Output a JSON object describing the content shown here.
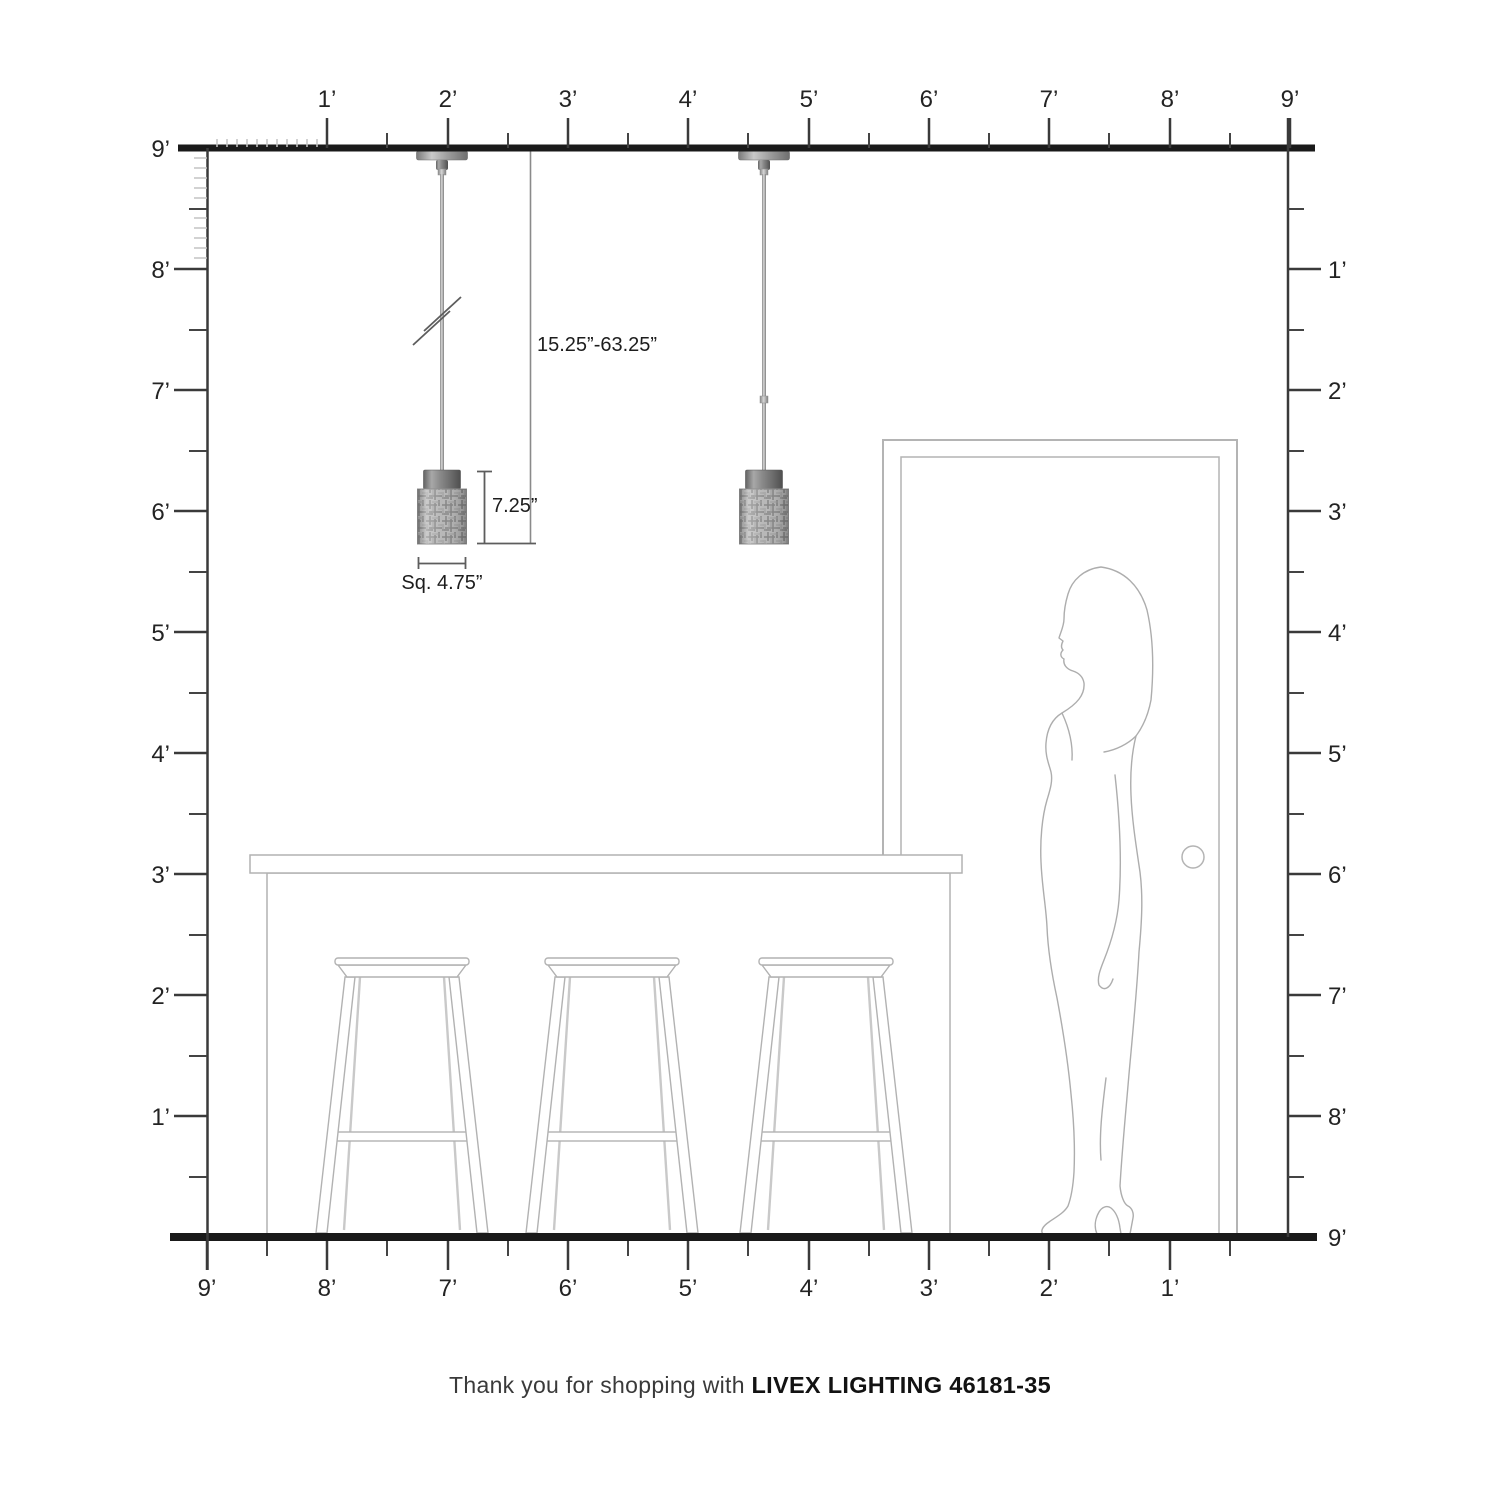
{
  "diagram": {
    "type": "product scale drawing",
    "scene": "two mini pendant lights over kitchen island with three bar stools, door and standing woman for scale"
  },
  "rulers": {
    "unit": "feet",
    "top": {
      "labels": [
        "1’",
        "2’",
        "3’",
        "4’",
        "5’",
        "6’",
        "7’",
        "8’",
        "9’"
      ]
    },
    "left": {
      "labels": [
        "9’",
        "8’",
        "7’",
        "6’",
        "5’",
        "4’",
        "3’",
        "2’",
        "1’"
      ]
    },
    "right": {
      "labels": [
        "1’",
        "2’",
        "3’",
        "4’",
        "5’",
        "6’",
        "7’",
        "8’",
        "9’"
      ]
    },
    "bottom": {
      "labels": [
        "9’",
        "8’",
        "7’",
        "6’",
        "5’",
        "4’",
        "3’",
        "2’",
        "1’"
      ]
    }
  },
  "dimensions": {
    "hang_range": "15.25”-63.25”",
    "shade_height": "7.25”",
    "shade_width": "Sq. 4.75”"
  },
  "footer": {
    "prefix": "Thank you for shopping with ",
    "brand_model": "LIVEX LIGHTING 46181-35"
  },
  "colors": {
    "structure_line": "#1a1a1a",
    "ruler_line": "#3a3a3a",
    "inch_tick": "#c3c3c3",
    "furniture_outline": "#b2b2b2",
    "silhouette_outline": "#adadad",
    "metal_gray": "#8a8a8a",
    "shade_gray": "#b7b7b7"
  }
}
